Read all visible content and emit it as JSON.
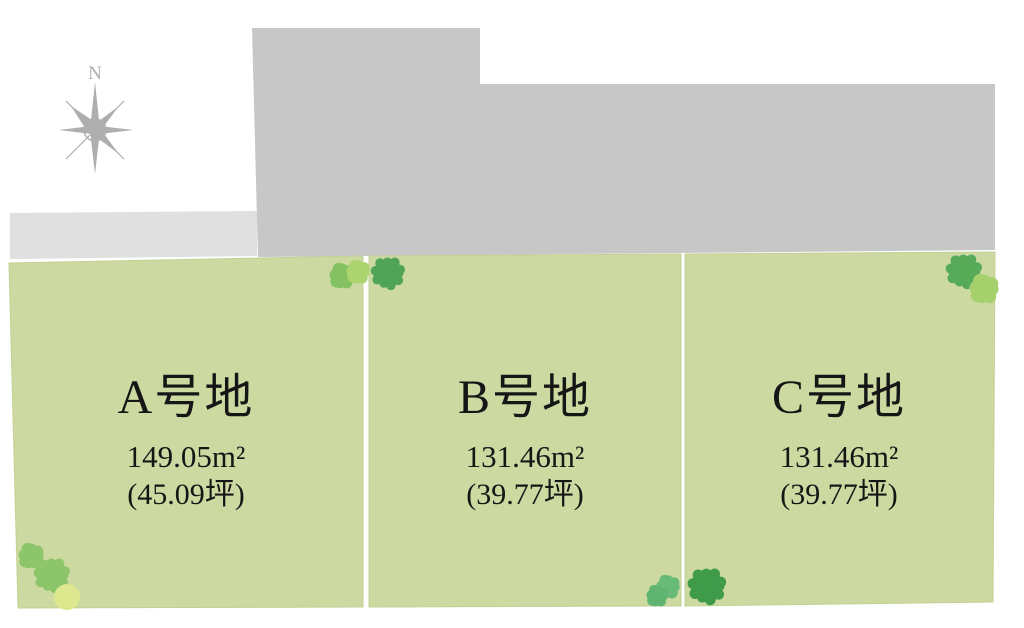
{
  "compass": {
    "label": "N"
  },
  "plots": [
    {
      "id": "A",
      "name": "A号地",
      "area": "149.05m²",
      "tsubo": "(45.09坪)"
    },
    {
      "id": "B",
      "name": "B号地",
      "area": "131.46m²",
      "tsubo": "(39.77坪)"
    },
    {
      "id": "C",
      "name": "C号地",
      "area": "131.46m²",
      "tsubo": "(39.77坪)"
    }
  ],
  "colors": {
    "background": "#ffffff",
    "plot_fill": "#ccd9a1",
    "plot_edge": "#c2d193",
    "building_fill": "#c6c7c6",
    "road_fill": "#dfe0df",
    "compass": "#aeaeae",
    "text": "#161616"
  },
  "trees": [
    {
      "name": "tree",
      "shape": "fluffy",
      "x": 342,
      "y": 276,
      "r": 13,
      "color": "#84c162"
    },
    {
      "name": "tree",
      "shape": "fluffy",
      "x": 358,
      "y": 272,
      "r": 12,
      "color": "#abd46e"
    },
    {
      "name": "tree",
      "shape": "spiky",
      "x": 388,
      "y": 273,
      "r": 16,
      "color": "#4fa457"
    },
    {
      "name": "tree",
      "shape": "spiky",
      "x": 964,
      "y": 271,
      "r": 17,
      "color": "#57aa58"
    },
    {
      "name": "tree",
      "shape": "fluffy",
      "x": 984,
      "y": 289,
      "r": 15,
      "color": "#a5d06c"
    },
    {
      "name": "tree",
      "shape": "fluffy",
      "x": 31,
      "y": 556,
      "r": 13,
      "color": "#8cc56a"
    },
    {
      "name": "tree",
      "shape": "spiky",
      "x": 52,
      "y": 575,
      "r": 17,
      "color": "#8cc56a"
    },
    {
      "name": "tree",
      "shape": "round",
      "x": 67,
      "y": 597,
      "r": 13,
      "color": "#dce78e"
    },
    {
      "name": "tree",
      "shape": "fluffy",
      "x": 668,
      "y": 587,
      "r": 12,
      "color": "#68ba77"
    },
    {
      "name": "tree",
      "shape": "fluffy",
      "x": 657,
      "y": 596,
      "r": 11,
      "color": "#5fb471"
    },
    {
      "name": "tree",
      "shape": "spiky",
      "x": 707,
      "y": 586,
      "r": 18,
      "color": "#3f9b4a"
    }
  ]
}
